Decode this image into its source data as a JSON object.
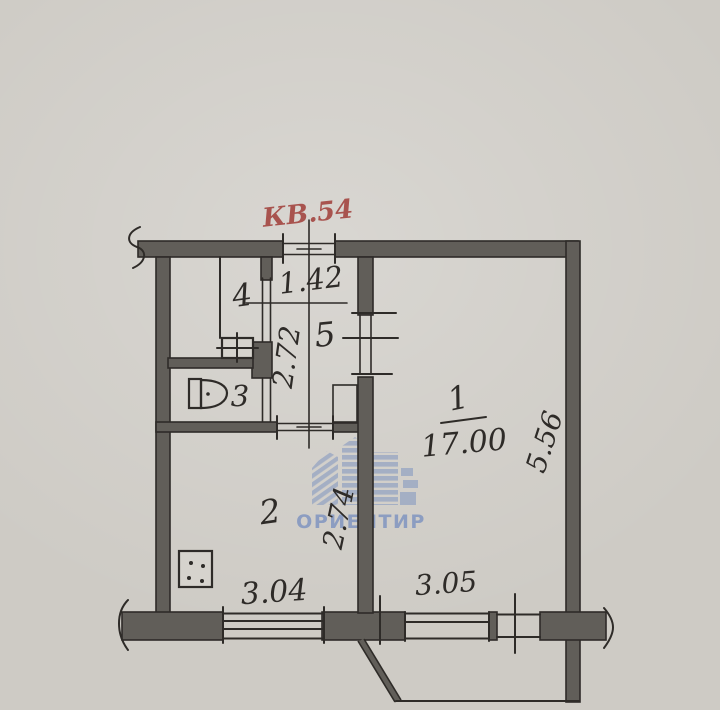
{
  "plan": {
    "apartment_label": "КВ.54",
    "rooms": {
      "living": {
        "number": "1",
        "area": "17.00"
      },
      "kitchen": {
        "number": "2"
      },
      "bathroom": {
        "number": "3"
      },
      "closet": {
        "number": "4"
      },
      "hall": {
        "number": "5"
      }
    },
    "dimensions": {
      "hall_width": "1.42",
      "hall_depth": "2.72",
      "living_depth": "5.56",
      "kitchen_depth": "2.74",
      "kitchen_width": "3.04",
      "living_width": "3.05"
    },
    "symbols": {
      "toilet": "toilet-bowl-with-tank",
      "sink": "square-with-cross",
      "stove": "square-with-four-dots"
    },
    "watermark": {
      "text": "ОРИЕНТИР"
    }
  },
  "colors": {
    "paper": "#cecbc5",
    "ink": "#2e2b28",
    "wall": "#615e59",
    "red": "#a8534e",
    "watermark": "#8095c0"
  }
}
